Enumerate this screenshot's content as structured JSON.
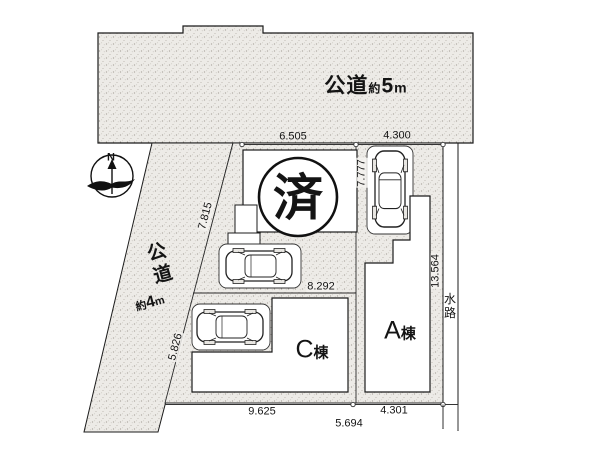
{
  "plan_type": "site-plan",
  "roads": {
    "top": {
      "kanji": "公道",
      "approx": "約",
      "width": "5",
      "unit": "m"
    },
    "left": {
      "k1": "公",
      "k2": "道",
      "approx": "約",
      "width": "4",
      "unit": "m"
    }
  },
  "waterway": {
    "k1": "水",
    "k2": "路"
  },
  "buildings": {
    "a": {
      "letter": "A",
      "suffix": "棟"
    },
    "c": {
      "letter": "C",
      "suffix": "棟"
    }
  },
  "sold_mark": "済",
  "compass": {
    "north": "N"
  },
  "dimensions": {
    "north_west": "6.505",
    "north_east": "4.300",
    "east_parking": "7.777",
    "west_upper": "7.815",
    "center": "8.292",
    "east_side": "13.564",
    "west_lower": "5.826",
    "south_west": "9.625",
    "south_center": "5.694",
    "south_east": "4.301"
  },
  "colors": {
    "paper": "#ffffff",
    "ink": "#1b1b1b",
    "stipple_bg": "#edebe7"
  }
}
